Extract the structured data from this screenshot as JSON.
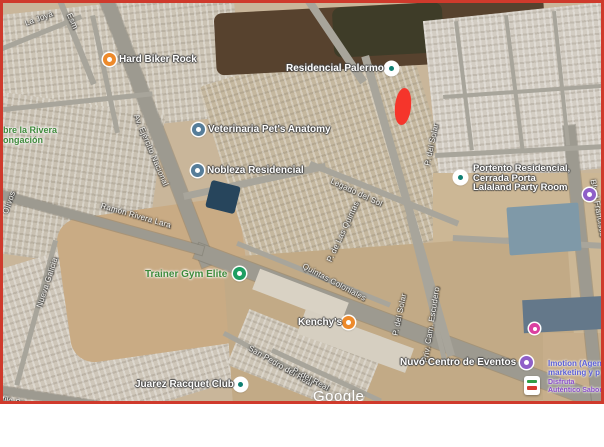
{
  "frame": {
    "border_color": "#cf3a2c",
    "background": "#ffffff"
  },
  "watermark": "Google",
  "streets": {
    "la_joya": "La Joya",
    "esmeralda": "Esm",
    "av_ejercito_nacional": "Av. Ejército Nacional",
    "ramon_rivera_lara": "Ramón Rivera Lara",
    "olivos": "Olivos",
    "nueva_galicia": "Nueva Galicia",
    "legado_del_sol": "Legado del Sol",
    "p_de_las_quintas": "P. de Las Quintas",
    "quintas_coloniales": "Quintas Coloniales",
    "p_del_solar_north": "P. del Solar",
    "p_del_solar_south": "P. del Solar",
    "priv_cam_escudero": "Priv. Cam. Escudero",
    "san_pedro_del_real": "San Pedro del Real",
    "p_del_real": "P. del Real",
    "teofilo_borunda": "Teófilo Borunda",
    "blvrd_francisco": "Blvrd Francisco"
  },
  "pois": {
    "hard_biker_rock": "Hard Biker Rock",
    "residencial_palermo": "Residencial Palermo",
    "veterinaria_pets_anatomy": "Veterinaria Pet's Anatomy",
    "nobleza_residencial": "Nobleza Residencial",
    "trainer_gym_elite": "Trainer Gym Elite",
    "kenchys": "Kenchy's",
    "juarez_racquet_club": "Juarez Racquet Club",
    "nuvo_centro_de_eventos": "Nuvó Centro de Eventos",
    "portento_line1": "Portento Residencial,",
    "portento_line2": "Cerrada Porta",
    "portento_line3": "Lalaland Party Room"
  },
  "area_labels": {
    "park_line1": "bre la Rivera",
    "park_line2": "ongación"
  },
  "ads": {
    "imotion_line1": "Imotion (Agen",
    "imotion_line2": "marketing y p",
    "disfruta_line1": "Disfruta",
    "disfruta_line2": "Auténtico Sabor"
  },
  "colors": {
    "poi_orange": "#ed8a2b",
    "poi_green": "#1e9e62",
    "poi_purple": "#8f5fc8",
    "poi_blue_gray": "#567d99",
    "poi_teal": "#0e7f72",
    "marker_red": "#f5352b",
    "pink_marker": "#db3fa0",
    "park_green": "#3f8a3c",
    "ad_blue": "#5b5fd6",
    "ad_purple": "#8a4fc9"
  }
}
